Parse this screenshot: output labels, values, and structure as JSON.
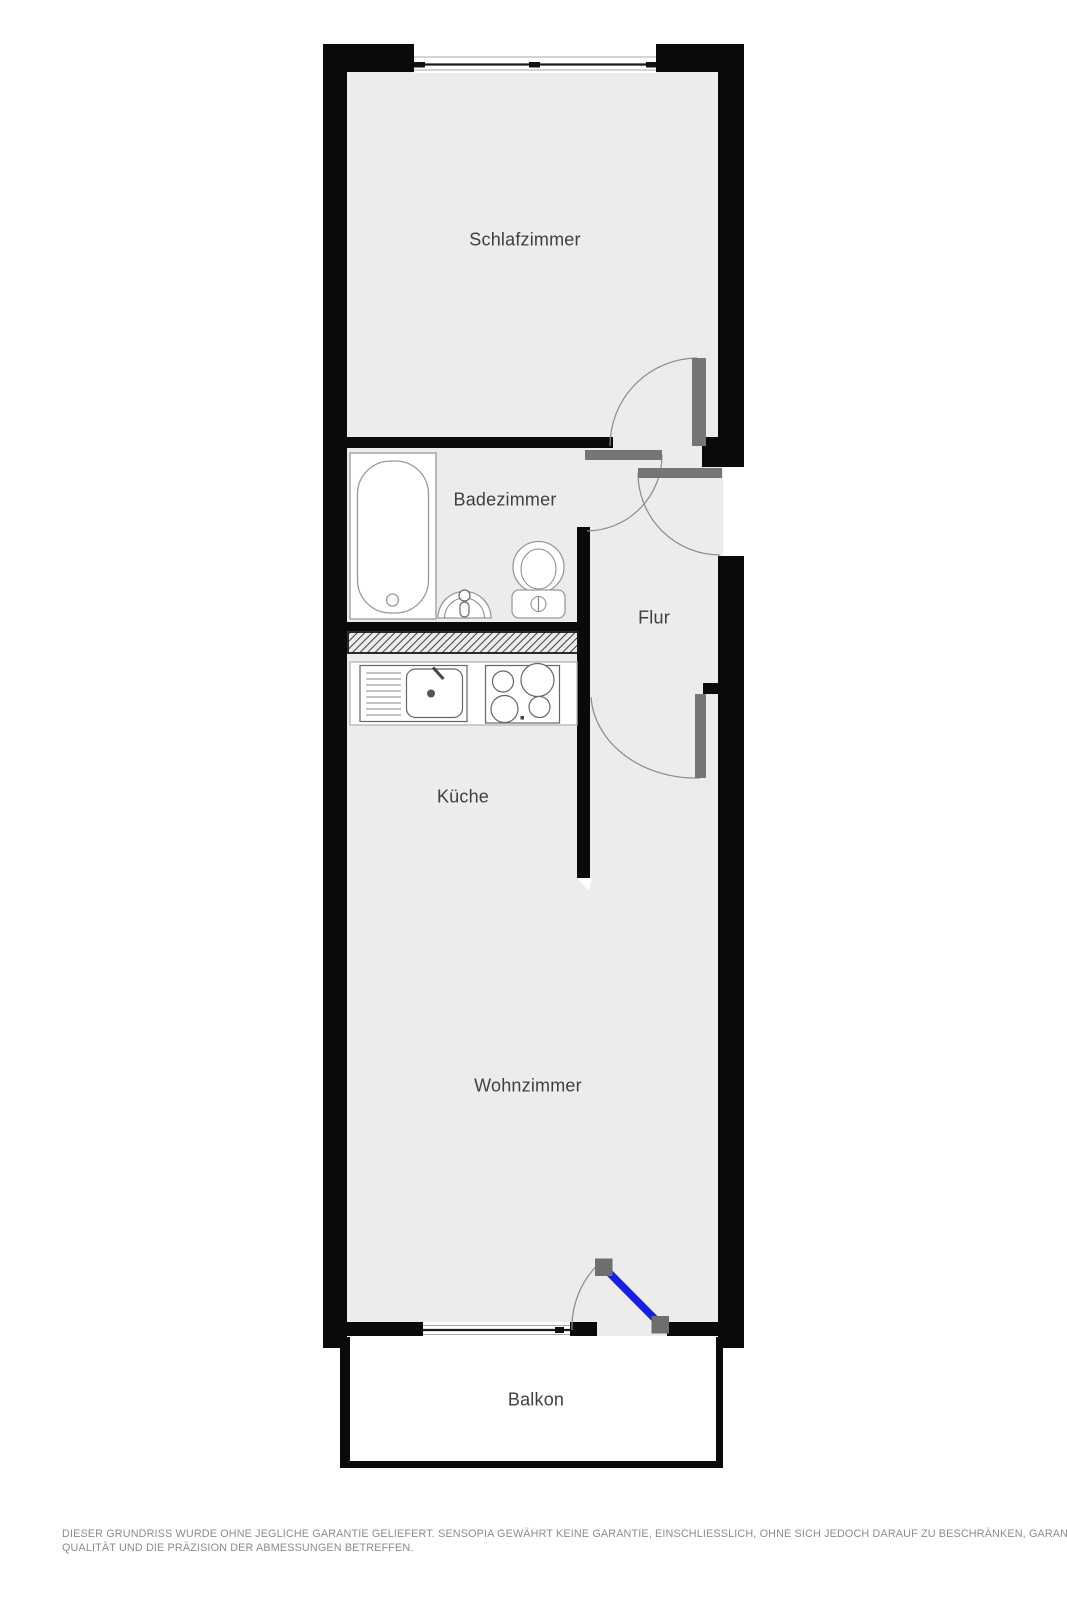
{
  "title": "Grundriss (floor plan)",
  "colors": {
    "wall": "#0a0a0a",
    "floor": "#ececec",
    "door_leaf": "#757575",
    "hinge": "#6e6e6e",
    "balcony_door": "#1d1de0",
    "label": "#3f3f3f",
    "disclaimer": "#8c8c8c"
  },
  "rooms": {
    "schlafzimmer": "Schlafzimmer",
    "badezimmer": "Badezimmer",
    "flur": "Flur",
    "kueche": "Küche",
    "wohnzimmer": "Wohnzimmer",
    "balkon": "Balkon"
  },
  "disclaimer": {
    "line1": "DIESER GRUNDRISS WURDE OHNE JEGLICHE GARANTIE GELIEFERT. SENSOPIA GEWÄHRT KEINE GARANTIE, EINSCHLIESSLICH, OHNE SICH JEDOCH DARAUF ZU BESCHRÄNKEN, GARANTIEN, DIE DIE",
    "line2": "QUALITÄT UND DIE PRÄZISION DER ABMESSUNGEN BETREFFEN."
  }
}
